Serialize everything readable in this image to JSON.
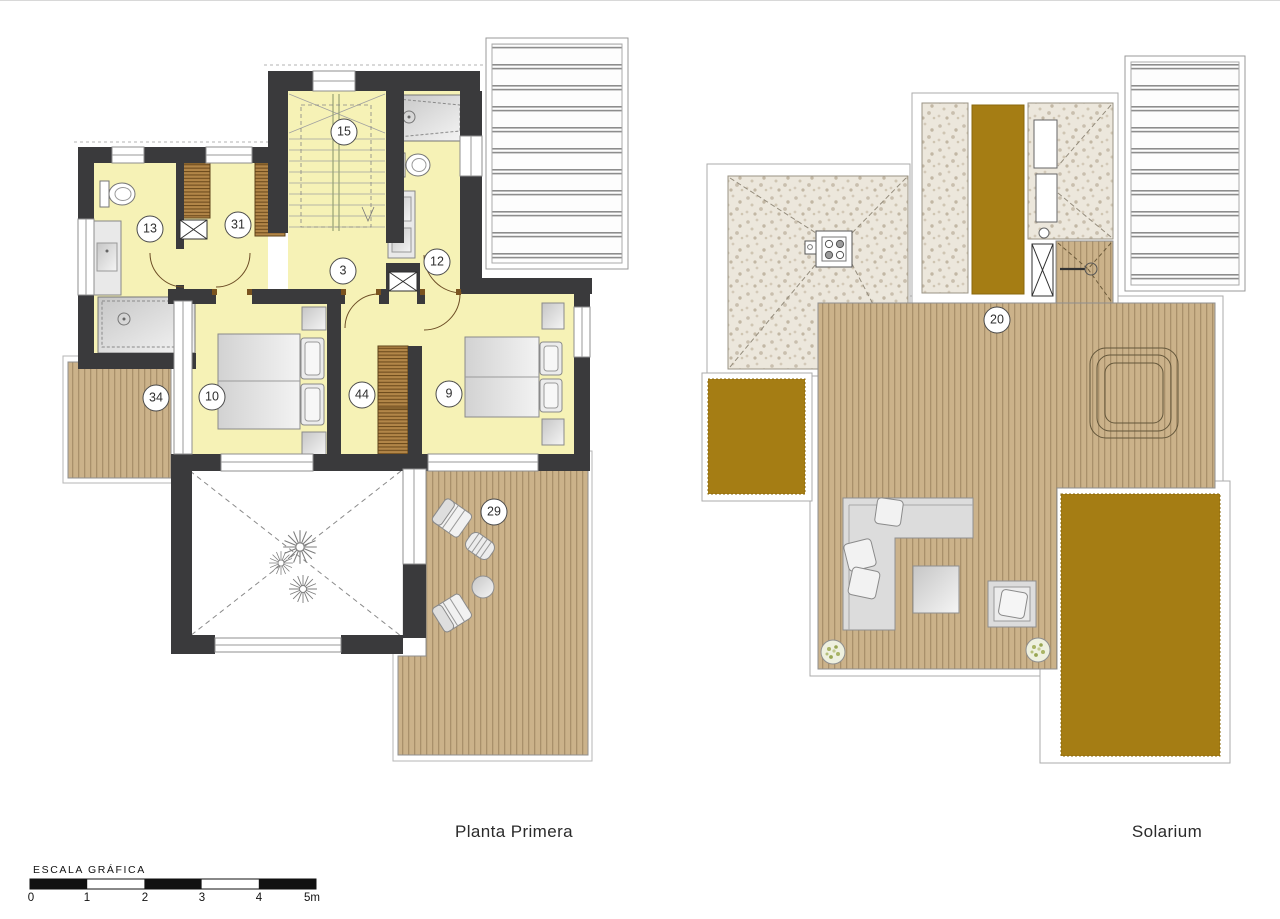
{
  "plans": [
    {
      "label": "Planta Primera",
      "rooms": [
        {
          "number": "15"
        },
        {
          "number": "13"
        },
        {
          "number": "31"
        },
        {
          "number": "3"
        },
        {
          "number": "12"
        },
        {
          "number": "34"
        },
        {
          "number": "10"
        },
        {
          "number": "44"
        },
        {
          "number": "9"
        },
        {
          "number": "29"
        }
      ]
    },
    {
      "label": "Solarium",
      "rooms": [
        {
          "number": "20"
        }
      ]
    }
  ],
  "scale_bar": {
    "title": "ESCALA GRÁFICA",
    "ticks": [
      "0",
      "1",
      "2",
      "3",
      "4",
      "5m"
    ]
  },
  "colors": {
    "paper": "#ffffff",
    "room_fill": "#f6f2b6",
    "wall": "#3a3a3c",
    "deck_wood": "#cbb28a",
    "deck_line": "#a9906b",
    "ochre_roof": "#a57d14",
    "gravel": "#ece7dc",
    "wardrobe": "#b28648",
    "furniture_gray": "#dcdcdc"
  }
}
